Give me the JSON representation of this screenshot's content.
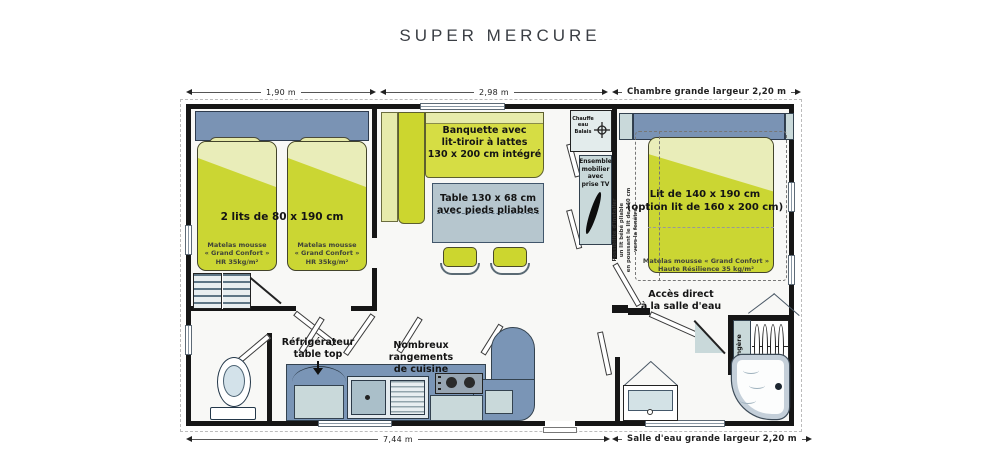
{
  "title": "SUPER MERCURE",
  "dimensions": {
    "top_left": "1,90 m",
    "top_mid": "2,98 m",
    "top_right": "Chambre grande largeur 2,20 m",
    "bottom_left": "7,44 m",
    "bottom_right": "Salle d'eau grande largeur 2,20 m"
  },
  "left_bedroom": {
    "beds_label": "2 lits de 80 x 190 cm",
    "mattress_note": "Matelas mousse\n« Grand Confort »\nHR 35kg/m²"
  },
  "living": {
    "banquette_label": "Banquette avec\nlit-tiroir à lattes\n130 x 200 cm intégré",
    "table_label": "Table 130 x 68 cm\navec pieds pliables",
    "water_heater_label": "Chauffe\neau\nBalais",
    "tv_cabinet_label": "Ensemble\nmobilier\navec\nprise TV"
  },
  "right_bedroom": {
    "bed_label": "Lit de 140 x 190 cm\n(option lit de 160 x 200 cm)",
    "mattress_note": "Matelas mousse « Grand Confort »\nHaute Résilience 35 kg/m²",
    "baby_bed_note": "Possibilité d'installer\nun lit bébé pliable\nen poussant le lit de 140 cm\nvers la fenêtre"
  },
  "bathroom": {
    "access_label": "Accès direct\nà la salle d'eau",
    "linen_label": "Lingère"
  },
  "kitchen": {
    "fridge_label": "Réfrigérateur\ntable top",
    "storage_label": "Nombreux rangements\nde cuisine"
  },
  "colors": {
    "mattress": "#cbd633",
    "mattress_light": "#e9edb9",
    "banquette": "#d6dd44",
    "headboard": "#7a93b4",
    "counter_blue": "#7a95b6",
    "table_top": "#b6c6ce",
    "cabinet_teal": "#c9d9da",
    "wall": "#161616"
  }
}
